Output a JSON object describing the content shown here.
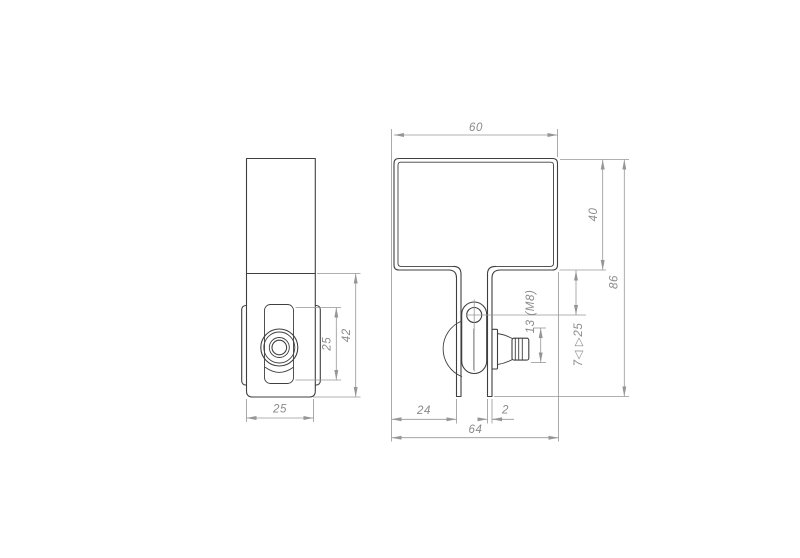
{
  "drawing": {
    "type": "technical-drawing",
    "part": "clamp bracket",
    "colors": {
      "background": "#ffffff",
      "part_line": "#3f3f3f",
      "dimension_line": "#969696",
      "dimension_text": "#8a8a8a"
    },
    "side_view": {
      "dims": {
        "slot_height": "25",
        "overall_height": "42",
        "width": "25"
      }
    },
    "front_view": {
      "dims": {
        "top_width": "60",
        "flange_height": "40",
        "overall_height": "86",
        "knob_spec": "13 (M8)",
        "clamp_range": "7◁ ▷25",
        "left_offset": "24",
        "thickness": "2",
        "overall_width": "64"
      }
    }
  }
}
